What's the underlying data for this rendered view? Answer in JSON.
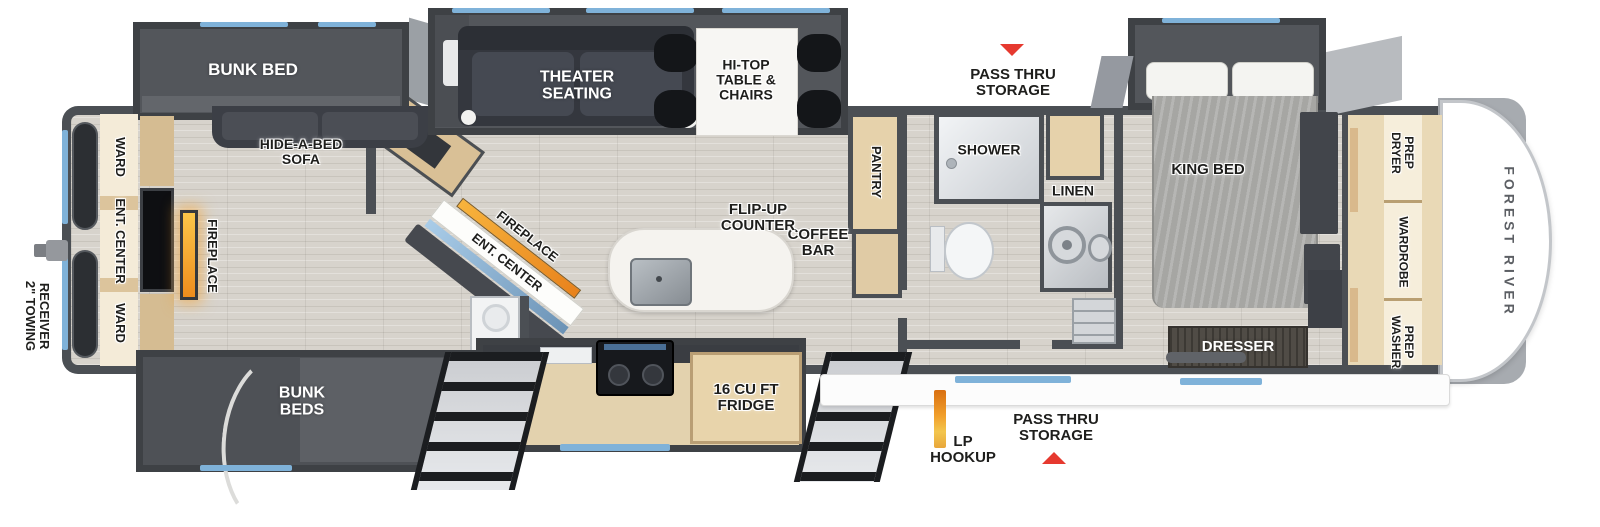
{
  "title": "Forest River fifth wheel bunkhouse floorplan",
  "colors": {
    "wall_gray": "#4b4f54",
    "slide_gray": "#53565b",
    "floor_tan": "#d7d3cc",
    "cabinet_tan": "#e6d2ab",
    "window_blue": "#7fb2d9",
    "arrow_red": "#e6392f",
    "fireplace_orange": "#ee8d1d"
  },
  "exterior": {
    "brand_vertical": "FOREST RIVER",
    "towing_receiver": "2\" TOWING\nRECEIVER",
    "lp_hookup": "LP\nHOOKUP",
    "pass_thru_storage_top": "PASS THRU\nSTORAGE",
    "pass_thru_storage_bottom": "PASS THRU\nSTORAGE"
  },
  "bunkhouse": {
    "bunk_bed_slide": "BUNK BED",
    "bunk_beds_slide": "BUNK\nBEDS",
    "hide_a_bed_sofa": "HIDE-A-BED\nSOFA",
    "ward_rear_top": "WARD",
    "ent_center_rear": "ENT. CENTER",
    "ward_rear_bottom": "WARD",
    "fireplace_rear": "FIREPLACE"
  },
  "living_kitchen": {
    "theater_seating": "THEATER\nSEATING",
    "hi_top_table": "HI-TOP\nTABLE &\nCHAIRS",
    "flip_up_counter": "FLIP-UP\nCOUNTER",
    "coffee_bar": "COFFEE\nBAR",
    "ent_center_island": "ENT. CENTER",
    "fireplace_island": "FIREPLACE",
    "fridge": "16 CU FT\nFRIDGE",
    "pantry": "PANTRY"
  },
  "bathroom": {
    "shower": "SHOWER",
    "linen": "LINEN"
  },
  "bedroom": {
    "king_bed": "KING BED",
    "dresser": "DRESSER",
    "dryer_prep": "DRYER\nPREP",
    "wardrobe": "WARDROBE",
    "washer_prep": "WASHER\nPREP"
  }
}
